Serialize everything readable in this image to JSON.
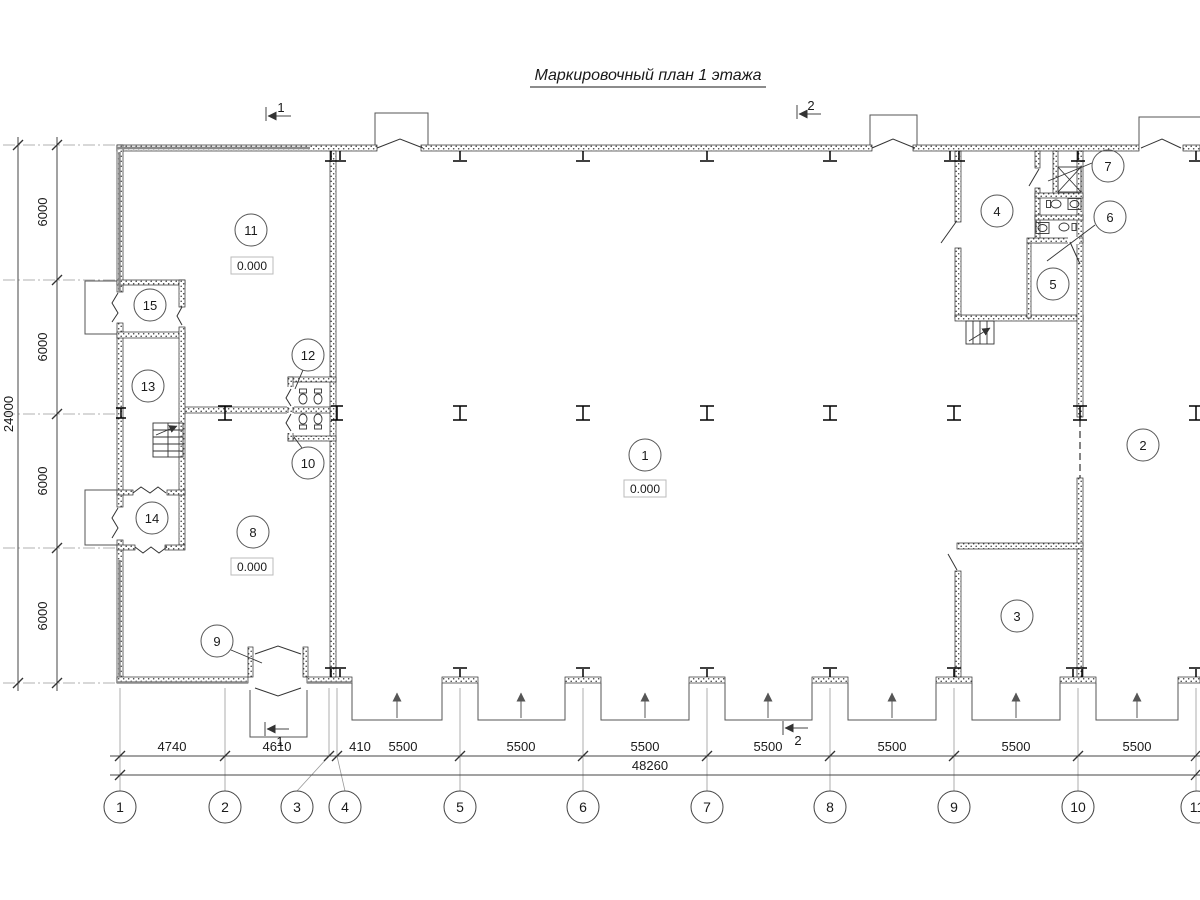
{
  "title": "Маркировочный план 1 этажа",
  "sections": {
    "s1": "1",
    "s2": "2"
  },
  "grid": {
    "cols": [
      "1",
      "2",
      "3",
      "4",
      "5",
      "6",
      "7",
      "8",
      "9",
      "10",
      "11"
    ],
    "col_dims": [
      "4740",
      "4610",
      "410",
      "5500",
      "5500",
      "5500",
      "5500",
      "5500",
      "5500",
      "5500"
    ],
    "total_width": "48260",
    "row_dims": [
      "6000",
      "6000",
      "6000",
      "6000"
    ],
    "total_height": "24000"
  },
  "rooms": {
    "r1": {
      "num": "1",
      "elev": "0.000"
    },
    "r2": {
      "num": "2"
    },
    "r3": {
      "num": "3"
    },
    "r4": {
      "num": "4"
    },
    "r5": {
      "num": "5"
    },
    "r6": {
      "num": "6"
    },
    "r7": {
      "num": "7"
    },
    "r8": {
      "num": "8",
      "elev": "0.000"
    },
    "r9": {
      "num": "9"
    },
    "r10": {
      "num": "10"
    },
    "r11": {
      "num": "11",
      "elev": "0.000"
    },
    "r12": {
      "num": "12"
    },
    "r13": {
      "num": "13"
    },
    "r14": {
      "num": "14"
    },
    "r15": {
      "num": "15"
    }
  },
  "colors": {
    "wall_dot": "#3a3a3a",
    "line": "#2a2a2a",
    "dim_text": "#1a1a1a"
  }
}
